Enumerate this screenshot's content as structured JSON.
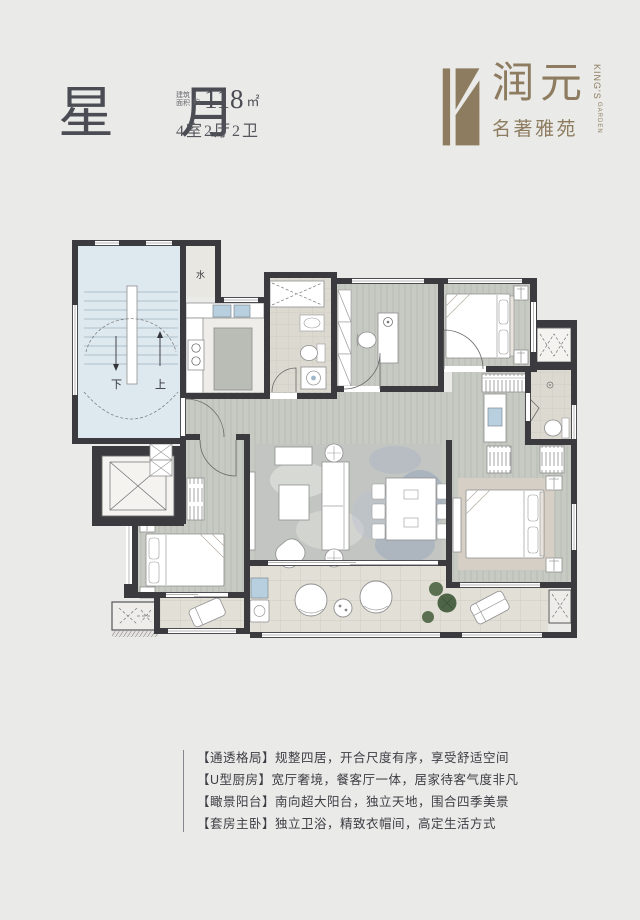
{
  "header": {
    "title": "星 月",
    "area_prefix_line1": "建筑",
    "area_prefix_line2": "面积",
    "area_approx": "约",
    "area_value": "118",
    "area_unit": "㎡",
    "layout": "4室2厅2卫"
  },
  "logo": {
    "brand": "润元",
    "sub": "名著雅苑",
    "en_line1": "KING'S",
    "en_line2": "GARDEN",
    "color": "#8d7c60"
  },
  "plan": {
    "labels": {
      "water": "水",
      "down": "下",
      "up": "上"
    },
    "colors": {
      "wall": "#3b3b3f",
      "stair_floor": "#dde8ef",
      "wood_floor": "#c7cac3",
      "tile_floor": "#e2dfd6",
      "bath_floor": "#dcd9d0",
      "rug_gray": "#c2c5c2",
      "rug_blue": "#8fa0bc",
      "plant_green": "#5a7050"
    }
  },
  "features": {
    "items": [
      {
        "text": "【通透格局】规整四居，开合尺度有序，享受舒适空间"
      },
      {
        "text": "【U型厨房】宽厅奢境，餐客厅一体，居家待客气度非凡"
      },
      {
        "text": "【瞰景阳台】南向超大阳台，独立天地，围合四季美景"
      },
      {
        "text": "【套房主卧】独立卫浴，精致衣帽间，高定生活方式"
      }
    ]
  }
}
